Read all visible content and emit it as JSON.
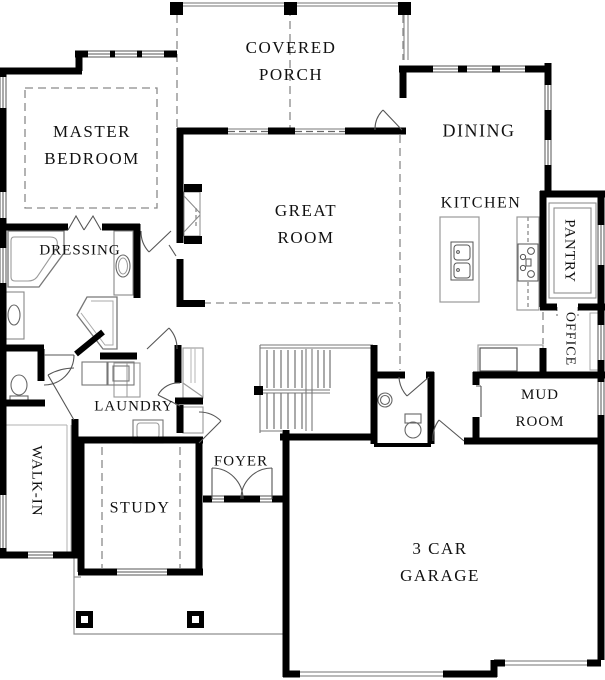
{
  "plan_title": "First floor plan",
  "rooms": {
    "covered_porch": {
      "label": "COVERED\nPORCH"
    },
    "master_bedroom": {
      "label": "MASTER\nBEDROOM"
    },
    "dining": {
      "label": "DINING"
    },
    "great_room": {
      "label": "GREAT\nROOM"
    },
    "kitchen": {
      "label": "KITCHEN"
    },
    "pantry": {
      "label": "PANTRY"
    },
    "office": {
      "label": "OFFICE"
    },
    "dressing": {
      "label": "DRESSING"
    },
    "laundry": {
      "label": "LAUNDRY"
    },
    "mud_room": {
      "label": "MUD ROOM"
    },
    "walk_in": {
      "label": "WALK-IN"
    },
    "foyer": {
      "label": "FOYER"
    },
    "study": {
      "label": "STUDY"
    },
    "garage": {
      "label": "3 CAR\nGARAGE"
    }
  },
  "palette": {
    "wall": "#000000",
    "thin_line": "#8f8f8f",
    "dash_line": "#8a8a8a",
    "fixture_line": "#666666",
    "text": "#111111",
    "background": "#ffffff"
  }
}
